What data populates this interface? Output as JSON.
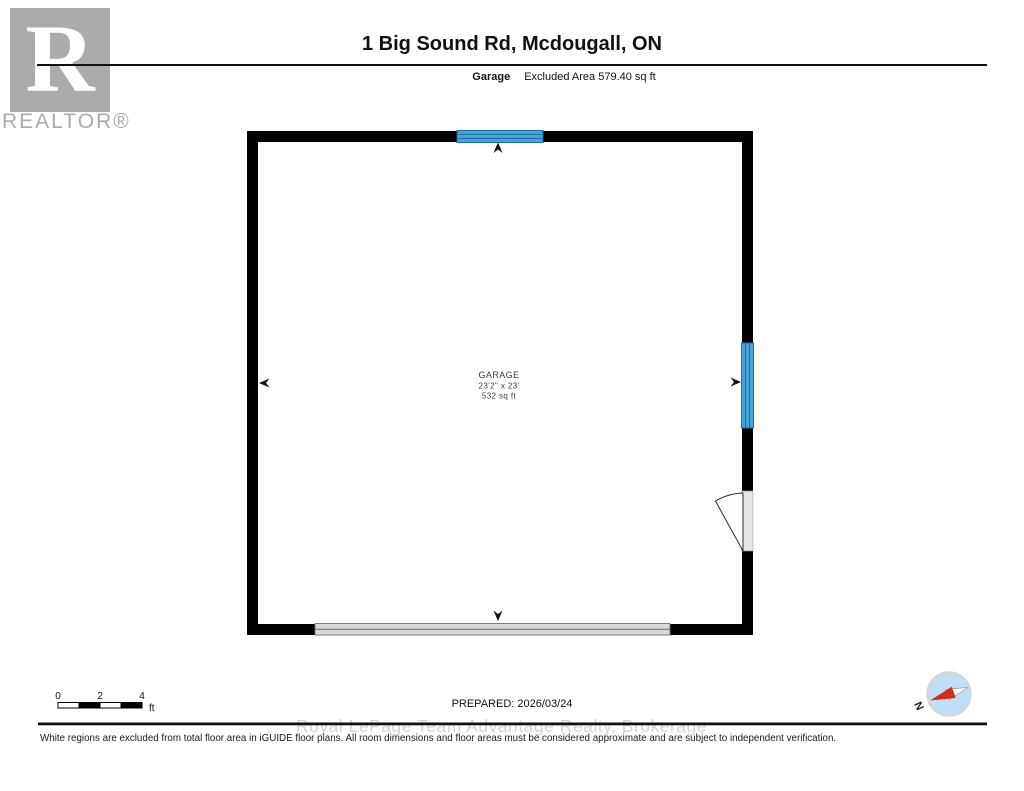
{
  "header": {
    "brand": {
      "letter": "R",
      "name": "REALTOR®"
    },
    "title": "1 Big Sound Rd, Mcdougall, ON",
    "floor_label": "Garage",
    "floor_note": "Excluded Area 579.40 sq ft"
  },
  "plan": {
    "room": {
      "name": "GARAGE",
      "dimensions": "23'2\" x 23'",
      "area": "532 sq ft"
    }
  },
  "scale_bar": {
    "tick0": "0",
    "tick2": "2",
    "tick4": "4",
    "unit": "ft"
  },
  "compass": {
    "north_label": "N"
  },
  "footer": {
    "prepared": "PREPARED: 2026/03/24",
    "watermark": "Royal LePage Team Advantage Realty, Brokerage",
    "disclaimer": "White regions are excluded from total floor area in iGUIDE floor plans. All room dimensions and floor areas must be considered approximate and are subject to independent verification."
  },
  "colors": {
    "window-blue": "#4aa3d8",
    "window-line": "#1b6ea6",
    "garage-door-gray": "#d9d9d9",
    "door-gray": "#e6e6e6",
    "compass-blue": "#bfe0f4",
    "compass-red": "#d9291c",
    "logo-gray": "#ababab",
    "watermark-gray": "#d4d4d4"
  }
}
